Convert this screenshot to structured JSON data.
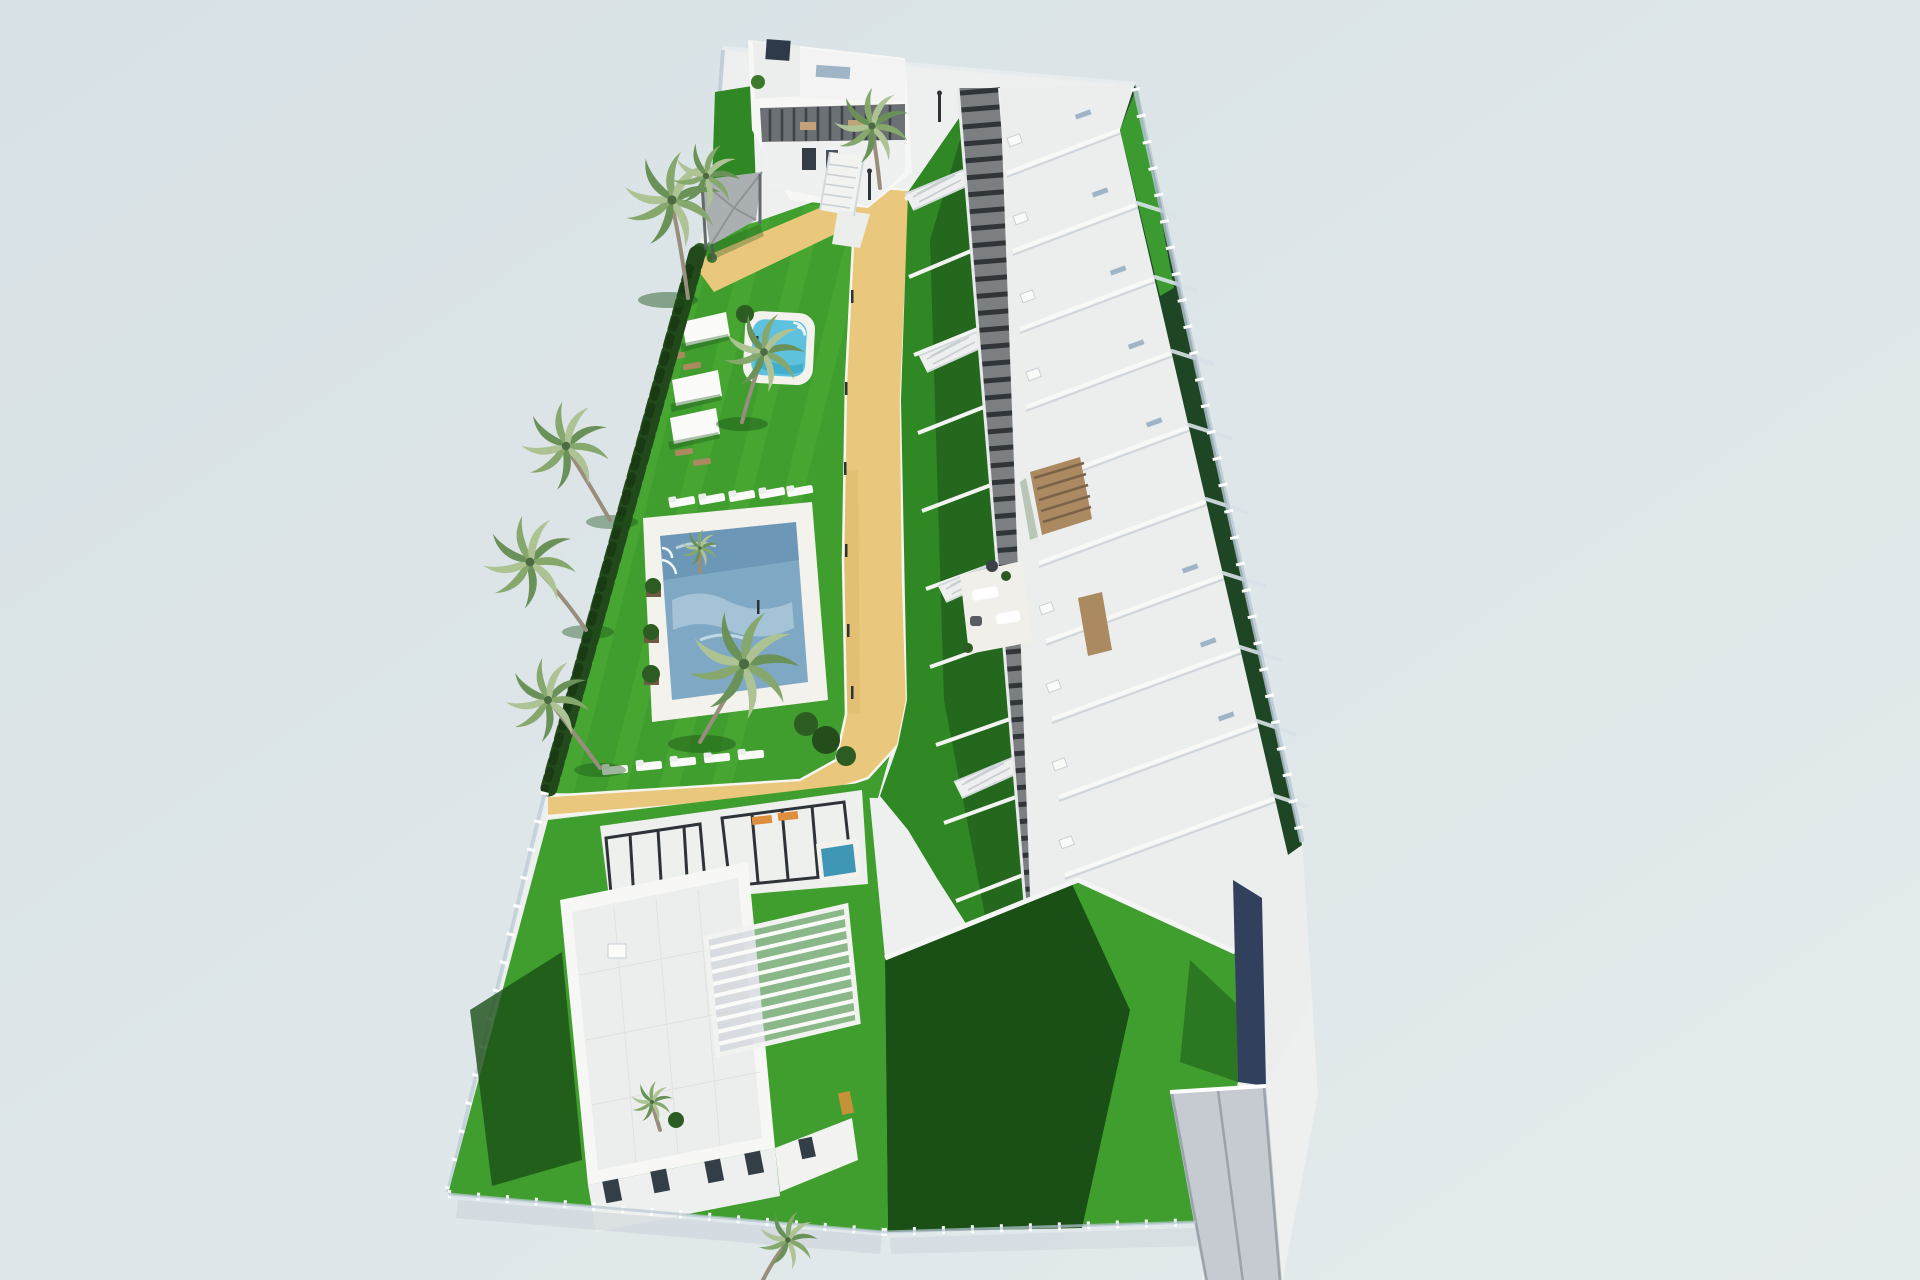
{
  "meta": {
    "description": "Aerial 3D architectural rendering of a residential development: a long row of white terraced townhouses with roof terraces along the right, a communal garden with a large rectangular pool, a small plunge pool, palm trees, shade sails and sun loungers in the centre, a detached white villa at the top and another detached villa with a white slatted pergola at the bottom, all enclosed by a glass perimeter fence on a pale blue-grey background."
  },
  "colors": {
    "background": "#dce4e7",
    "backgroundLight": "#e4ebed",
    "sidewalk": "#eef0ef",
    "shadowBlue": "#c7d0d8",
    "lawn": "#3f9e2d",
    "lawnLight": "#58b43c",
    "lawnDim": "#2f8824",
    "lawnShadow": "#1a4f16",
    "gardenDark": "#1e4625",
    "gardenLit": "#3b9b30",
    "hedge": "#22491b",
    "poolWater": "#7fa8c4",
    "poolWaterDark": "#5e88ab",
    "poolRipple": "#c9dde8",
    "kidneyWater": "#5ec2df",
    "plungeWater": "#3f97b5",
    "deck": "#f3f2ed",
    "deckWhite": "#f7f5ef",
    "sand": "#e9c87d",
    "sandShade": "#d9b368",
    "white": "#f9f9f7",
    "roof": "#eceeed",
    "roofDim": "#e2e5e5",
    "wallShadow": "#c6cdd5",
    "wallDark": "#9aa5b0",
    "corridor": "#7b7f82",
    "corridorBeam": "#303539",
    "glass": "#b9c9d6",
    "glassLight": "#d9e2e8",
    "wood": "#ab8a61",
    "woodDark": "#6f5a42",
    "frameDark": "#2e3338",
    "window": "#333e47",
    "navy": "#31405c",
    "ramp": "#c5cbd0",
    "orange": "#dd8f3d",
    "palmA": "#87a86d",
    "palmB": "#6a9158",
    "palmC": "#aec394",
    "trunk": "#998e7d",
    "canopy": "#aab0b2",
    "canopyDark": "#63696d"
  },
  "scene": {
    "objects": [
      {
        "name": "townhouse-row",
        "label": "Row of white terraced townhouses with stepped roof terraces"
      },
      {
        "name": "corridor-walkway",
        "label": "Dark pergola-covered access walkway"
      },
      {
        "name": "communal-lawn",
        "label": "Communal garden lawn"
      },
      {
        "name": "main-pool",
        "label": "Large rectangular swimming pool"
      },
      {
        "name": "kidney-pool",
        "label": "Small plunge pool"
      },
      {
        "name": "villa-north",
        "label": "Detached villa at top of plot"
      },
      {
        "name": "villa-south",
        "label": "Detached villa with white slatted pergola at bottom"
      },
      {
        "name": "garage-ramp",
        "label": "Driveway ramp to underground garage"
      },
      {
        "name": "perimeter-fence",
        "label": "Glass perimeter fence"
      },
      {
        "name": "palm-trees",
        "label": "Palm trees"
      },
      {
        "name": "shade-sails",
        "label": "White shade sails with wooden loungers"
      },
      {
        "name": "sun-loungers",
        "label": "Rows of white sun loungers"
      },
      {
        "name": "sand-path",
        "label": "Sand-coloured garden paths"
      }
    ]
  }
}
